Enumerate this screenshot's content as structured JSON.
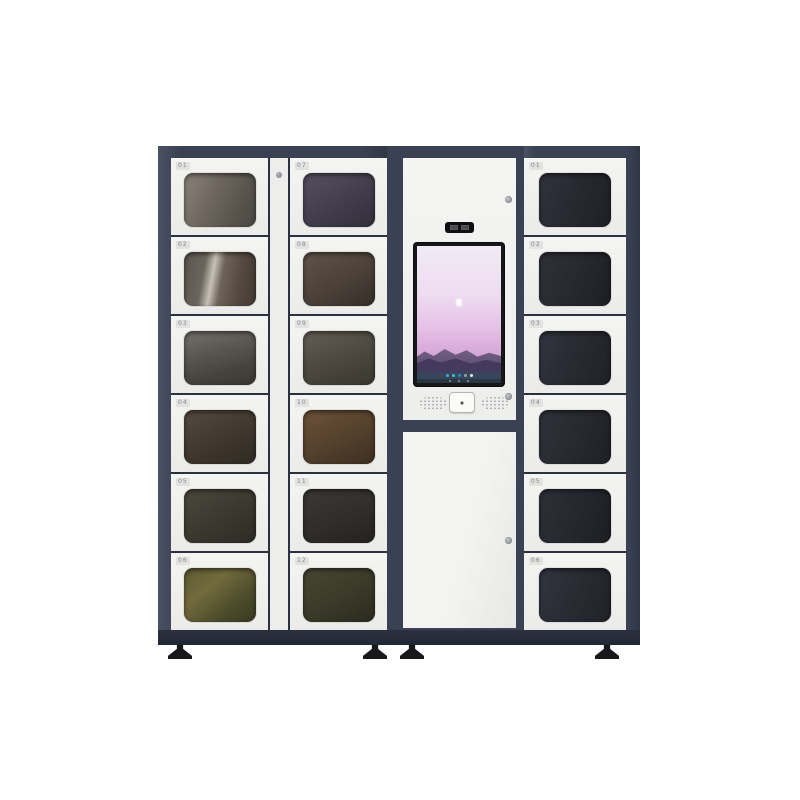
{
  "scene": {
    "description": "Product photo of a smart locker vending machine: two columns of glass-door lockers on the left, a central kiosk tower with portrait touchscreen, and one column of glass-door lockers on the right, standing on adjustable feet against a white background"
  },
  "palette": {
    "background": "#ffffff",
    "frame_navy": "#3a4152",
    "frame_dark": "#2b3140",
    "panel_white": "#f1f1ef",
    "screen_bezel": "#17171a",
    "screen_sky_top": "#f1eaf5",
    "screen_sky_pink": "#e6c3e8",
    "mountain_purple": "#584a6e",
    "taskbar_blue_gray": "#37465a",
    "foot_black": "#17171c"
  },
  "left_cabinet": {
    "column_a": {
      "lockers": [
        {
          "label": "01",
          "glass_style": "background:linear-gradient(115deg,#8a837b 0%,#6e675f 40%,#57524b 75%,#4a4842 100%)"
        },
        {
          "label": "02",
          "glass_style": "background:linear-gradient(100deg,#59544e 0%,#6b655c 28%,#c7c1b6 40%,#6e6459 52%,#55493f 75%,#433a32 100%)"
        },
        {
          "label": "03",
          "glass_style": "background:linear-gradient(165deg,#75716b 0%,#5c5953 35%,#46443f 70%,#38362f 100%)"
        },
        {
          "label": "04",
          "glass_style": "background:linear-gradient(155deg,#544a40 0%,#42392f 50%,#2f2a22 100%)"
        },
        {
          "label": "05",
          "glass_style": "background:linear-gradient(150deg,#4c493e 0%,#3c3a30 50%,#2c2b24 100%)"
        },
        {
          "label": "06",
          "glass_style": "background:linear-gradient(140deg,#5d5a33 0%,#716b3c 35%,#4c4b2b 70%,#383920 100%)"
        }
      ]
    },
    "column_b": {
      "lockers": [
        {
          "label": "07",
          "glass_style": "background:linear-gradient(150deg,#565061 0%,#443f4d 50%,#322e3a 100%)"
        },
        {
          "label": "08",
          "glass_style": "background:linear-gradient(150deg,#60544a 0%,#4b4139 55%,#352e27 100%)"
        },
        {
          "label": "09",
          "glass_style": "background:linear-gradient(160deg,#645e55 0%,#4f4b43 45%,#3a372f 100%)"
        },
        {
          "label": "10",
          "glass_style": "background:linear-gradient(155deg,#6d523a 0%,#56422e 50%,#3c2e21 100%)"
        },
        {
          "label": "11",
          "glass_style": "background:linear-gradient(160deg,#3b3936 0%,#302e2b 55%,#242321 100%)"
        },
        {
          "label": "12",
          "glass_style": "background:linear-gradient(150deg,#474733 0%,#3a3a29 55%,#2b2b1f 100%)"
        }
      ]
    }
  },
  "center_unit": {
    "camera_module": {
      "description": "black camera / indicator window above screen"
    },
    "screen": {
      "wallpaper": "pink-purple dusk sky over dark mountain silhouette",
      "taskbar": "dark taskbar strip with small app icons and navigation dots"
    },
    "scanner_button": {
      "description": "square scan / sensor button between two speaker grilles"
    },
    "lower_door": {
      "description": "blank service door with round lock"
    }
  },
  "right_cabinet": {
    "lockers": [
      {
        "label": "01",
        "glass_style": "background:linear-gradient(110deg,#31333c 0%,#282a32 45%,#1f2027 100%)"
      },
      {
        "label": "02",
        "glass_style": "background:linear-gradient(110deg,#2f3139 0%,#272930 50%,#1e1f26 100%)"
      },
      {
        "label": "03",
        "glass_style": "background:linear-gradient(110deg,#323440 0%,#292b33 45%,#202128 100%)"
      },
      {
        "label": "04",
        "glass_style": "background:linear-gradient(110deg,#30323b 0%,#282a31 50%,#1f2026 100%)"
      },
      {
        "label": "05",
        "glass_style": "background:linear-gradient(110deg,#2e3038 0%,#26282f 50%,#1d1e24 100%)"
      },
      {
        "label": "06",
        "glass_style": "background:linear-gradient(110deg,#33353f 0%,#2a2c34 45%,#212229 100%)"
      }
    ]
  }
}
